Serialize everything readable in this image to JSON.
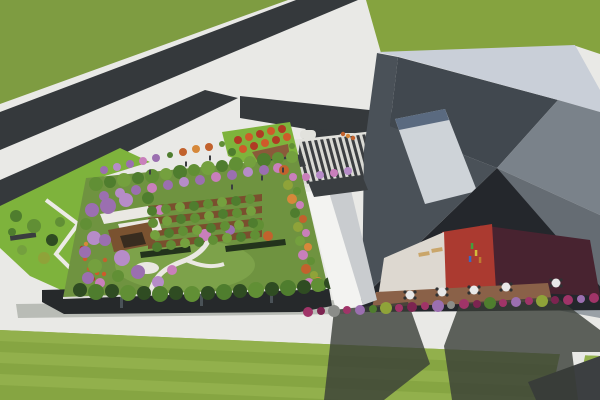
{
  "scene_description": "Aerial 3D architectural rendering: dark diagonal roads through green fields, a rectangular rooftop garden full of trees over a low glass building, a striped entry plaza, a long white canopy building, and a large angular gray building with a sunken courtyard containing red/maroon terraces, deck tables and figures; striped lawn with long building shadows below.",
  "palette": {
    "grassTop": "#7e9c41",
    "grassTop2": "#85a33f",
    "lawn": "#86a542",
    "lawnLight": "#92b04c",
    "sidewalk": "#e9e9e6",
    "road": "#35393c",
    "shade": "#383d37",
    "plazaLight": "#d9d9d4",
    "plazaDark": "#3b3e41",
    "apron": "#e2e2dd",
    "gardenLawn": "#6f9340",
    "gardenLawn2": "#7da24a",
    "soil": "#7a4f2e",
    "hedge": "#23331c",
    "facade": "#26292b",
    "facadeGlint": "#4a5257",
    "parapet": "#dcdcd8",
    "pathWhite": "#eae8e2",
    "deckBrown": "#8a6148",
    "pavilionRoof": "#eae8e3",
    "pavilionDeck": "#7a5230",
    "pavilionDark": "#382c1f",
    "courtWhite": "#ddd8d0",
    "courtRed": "#ab3a30",
    "courtMaroon": "#482330",
    "courtDark": "#24272c",
    "canopyLight": "#f3f3f1",
    "canopyMid": "#c9cccf",
    "bLight": "#c9cfd8",
    "bSunken": "#41484f",
    "bWallLeft": "#4a5158",
    "bPanel": "#ced3d8",
    "bPanelEdge": "#5a6a80",
    "bPlaneA": "#7a828a",
    "bPlaneB": "#656c73",
    "bPlaneC": "#99a0a6",
    "shelterDark": "#3a3e41",
    "benchDark": "#3a3d3f",
    "rampWhite": "#eceae6",
    "parkBright": "#7eb33c",
    "soilTri": "#8a5a3a",
    "darkCorner": "#3c3f41",
    "shadowSoft": "#b9bcb6",
    "tan": "#caa66a",
    "tableWhite": "#e8e8e8",
    "chairDark": "#2f3133",
    "g1": "#4f7d2e",
    "g2": "#618f35",
    "g3": "#74a03e",
    "dg": "#2f4c22",
    "ol": "#8fa339",
    "pu": "#9b6fb0",
    "pl": "#b68cc8",
    "pk": "#c97fbb",
    "or1": "#c2622d",
    "or2": "#d6883a",
    "r1": "#b03a24",
    "r2": "#cf5a2a",
    "mg": "#a03468",
    "mgd": "#7c2450",
    "gr": "#8b8d89"
  },
  "scene": {
    "trees": [
      {
        "x": 96,
        "y": 184,
        "r": 7,
        "c": "g2"
      },
      {
        "x": 110,
        "y": 182,
        "r": 6,
        "c": "g1"
      },
      {
        "x": 124,
        "y": 180,
        "r": 7,
        "c": "g3"
      },
      {
        "x": 138,
        "y": 178,
        "r": 6,
        "c": "g1"
      },
      {
        "x": 152,
        "y": 176,
        "r": 7,
        "c": "g2"
      },
      {
        "x": 166,
        "y": 174,
        "r": 6,
        "c": "g3"
      },
      {
        "x": 180,
        "y": 172,
        "r": 7,
        "c": "g1"
      },
      {
        "x": 194,
        "y": 170,
        "r": 6,
        "c": "g2"
      },
      {
        "x": 208,
        "y": 168,
        "r": 7,
        "c": "g3"
      },
      {
        "x": 222,
        "y": 166,
        "r": 6,
        "c": "g1"
      },
      {
        "x": 236,
        "y": 164,
        "r": 7,
        "c": "g2"
      },
      {
        "x": 250,
        "y": 162,
        "r": 6,
        "c": "g3"
      },
      {
        "x": 264,
        "y": 160,
        "r": 7,
        "c": "g1"
      },
      {
        "x": 278,
        "y": 158,
        "r": 6,
        "c": "g2"
      },
      {
        "x": 292,
        "y": 157,
        "r": 6,
        "c": "g3"
      },
      {
        "x": 104,
        "y": 196,
        "r": 5,
        "c": "pu"
      },
      {
        "x": 120,
        "y": 193,
        "r": 5,
        "c": "pl"
      },
      {
        "x": 136,
        "y": 190,
        "r": 5,
        "c": "pu"
      },
      {
        "x": 152,
        "y": 188,
        "r": 5,
        "c": "pk"
      },
      {
        "x": 168,
        "y": 185,
        "r": 5,
        "c": "pu"
      },
      {
        "x": 184,
        "y": 182,
        "r": 5,
        "c": "pl"
      },
      {
        "x": 200,
        "y": 180,
        "r": 5,
        "c": "pu"
      },
      {
        "x": 216,
        "y": 177,
        "r": 5,
        "c": "pk"
      },
      {
        "x": 232,
        "y": 175,
        "r": 5,
        "c": "pu"
      },
      {
        "x": 248,
        "y": 172,
        "r": 5,
        "c": "pl"
      },
      {
        "x": 264,
        "y": 170,
        "r": 5,
        "c": "pu"
      },
      {
        "x": 278,
        "y": 168,
        "r": 5,
        "c": "pk"
      },
      {
        "x": 92,
        "y": 210,
        "r": 7,
        "c": "pu"
      },
      {
        "x": 86,
        "y": 224,
        "r": 6,
        "c": "g2"
      },
      {
        "x": 94,
        "y": 238,
        "r": 7,
        "c": "pl"
      },
      {
        "x": 85,
        "y": 252,
        "r": 6,
        "c": "pu"
      },
      {
        "x": 95,
        "y": 266,
        "r": 7,
        "c": "g3"
      },
      {
        "x": 88,
        "y": 278,
        "r": 6,
        "c": "pu"
      },
      {
        "x": 100,
        "y": 283,
        "r": 5,
        "c": "pk"
      },
      {
        "x": 108,
        "y": 206,
        "r": 8,
        "c": "pu"
      },
      {
        "x": 126,
        "y": 200,
        "r": 7,
        "c": "pl"
      },
      {
        "x": 148,
        "y": 198,
        "r": 6,
        "c": "g1"
      },
      {
        "x": 160,
        "y": 210,
        "r": 5,
        "c": "pk"
      },
      {
        "x": 105,
        "y": 240,
        "r": 6,
        "c": "pu"
      },
      {
        "x": 122,
        "y": 258,
        "r": 8,
        "c": "pl"
      },
      {
        "x": 138,
        "y": 272,
        "r": 7,
        "c": "pu"
      },
      {
        "x": 158,
        "y": 282,
        "r": 6,
        "c": "pl"
      },
      {
        "x": 172,
        "y": 270,
        "r": 5,
        "c": "pk"
      },
      {
        "x": 118,
        "y": 276,
        "r": 6,
        "c": "g2"
      },
      {
        "x": 205,
        "y": 235,
        "r": 6,
        "c": "pk"
      },
      {
        "x": 230,
        "y": 230,
        "r": 5,
        "c": "pu"
      },
      {
        "x": 258,
        "y": 225,
        "r": 6,
        "c": "g2"
      },
      {
        "x": 268,
        "y": 236,
        "r": 5,
        "c": "or1"
      },
      {
        "x": 152,
        "y": 211,
        "r": 5,
        "c": "g1"
      },
      {
        "x": 166,
        "y": 209,
        "r": 5,
        "c": "g2"
      },
      {
        "x": 180,
        "y": 207,
        "r": 5,
        "c": "g3"
      },
      {
        "x": 194,
        "y": 206,
        "r": 5,
        "c": "g1"
      },
      {
        "x": 208,
        "y": 204,
        "r": 5,
        "c": "g2"
      },
      {
        "x": 222,
        "y": 202,
        "r": 5,
        "c": "g3"
      },
      {
        "x": 236,
        "y": 201,
        "r": 5,
        "c": "g1"
      },
      {
        "x": 250,
        "y": 199,
        "r": 5,
        "c": "g2"
      },
      {
        "x": 153,
        "y": 223,
        "r": 5,
        "c": "g2"
      },
      {
        "x": 167,
        "y": 221,
        "r": 5,
        "c": "g3"
      },
      {
        "x": 181,
        "y": 219,
        "r": 5,
        "c": "g1"
      },
      {
        "x": 195,
        "y": 218,
        "r": 5,
        "c": "g2"
      },
      {
        "x": 209,
        "y": 216,
        "r": 5,
        "c": "g3"
      },
      {
        "x": 223,
        "y": 214,
        "r": 5,
        "c": "g1"
      },
      {
        "x": 237,
        "y": 213,
        "r": 5,
        "c": "g2"
      },
      {
        "x": 251,
        "y": 211,
        "r": 5,
        "c": "g3"
      },
      {
        "x": 155,
        "y": 235,
        "r": 5,
        "c": "g3"
      },
      {
        "x": 169,
        "y": 233,
        "r": 5,
        "c": "g1"
      },
      {
        "x": 183,
        "y": 231,
        "r": 5,
        "c": "g2"
      },
      {
        "x": 197,
        "y": 230,
        "r": 5,
        "c": "g3"
      },
      {
        "x": 211,
        "y": 228,
        "r": 5,
        "c": "g1"
      },
      {
        "x": 225,
        "y": 226,
        "r": 5,
        "c": "g2"
      },
      {
        "x": 239,
        "y": 225,
        "r": 5,
        "c": "g3"
      },
      {
        "x": 253,
        "y": 223,
        "r": 5,
        "c": "g1"
      },
      {
        "x": 157,
        "y": 247,
        "r": 5,
        "c": "g1"
      },
      {
        "x": 171,
        "y": 245,
        "r": 5,
        "c": "g2"
      },
      {
        "x": 185,
        "y": 243,
        "r": 5,
        "c": "g3"
      },
      {
        "x": 199,
        "y": 242,
        "r": 5,
        "c": "g1"
      },
      {
        "x": 213,
        "y": 240,
        "r": 5,
        "c": "g2"
      },
      {
        "x": 227,
        "y": 238,
        "r": 5,
        "c": "g3"
      },
      {
        "x": 241,
        "y": 237,
        "r": 5,
        "c": "g1"
      },
      {
        "x": 255,
        "y": 235,
        "r": 5,
        "c": "g2"
      },
      {
        "x": 284,
        "y": 170,
        "r": 5,
        "c": "or1"
      },
      {
        "x": 293,
        "y": 177,
        "r": 4,
        "c": "pk"
      },
      {
        "x": 288,
        "y": 185,
        "r": 5,
        "c": "ol"
      },
      {
        "x": 297,
        "y": 191,
        "r": 4,
        "c": "g2"
      },
      {
        "x": 292,
        "y": 199,
        "r": 5,
        "c": "or2"
      },
      {
        "x": 300,
        "y": 205,
        "r": 4,
        "c": "pk"
      },
      {
        "x": 295,
        "y": 213,
        "r": 5,
        "c": "g1"
      },
      {
        "x": 303,
        "y": 219,
        "r": 4,
        "c": "or1"
      },
      {
        "x": 298,
        "y": 227,
        "r": 5,
        "c": "ol"
      },
      {
        "x": 306,
        "y": 233,
        "r": 4,
        "c": "pk"
      },
      {
        "x": 300,
        "y": 241,
        "r": 5,
        "c": "g3"
      },
      {
        "x": 308,
        "y": 247,
        "r": 4,
        "c": "or2"
      },
      {
        "x": 303,
        "y": 255,
        "r": 5,
        "c": "pk"
      },
      {
        "x": 311,
        "y": 261,
        "r": 4,
        "c": "g2"
      },
      {
        "x": 306,
        "y": 269,
        "r": 5,
        "c": "or1"
      },
      {
        "x": 314,
        "y": 275,
        "r": 4,
        "c": "ol"
      },
      {
        "x": 309,
        "y": 283,
        "r": 5,
        "c": "pk"
      },
      {
        "x": 318,
        "y": 281,
        "r": 4,
        "c": "or2"
      },
      {
        "x": 322,
        "y": 287,
        "r": 4,
        "c": "g1"
      },
      {
        "x": 80,
        "y": 290,
        "r": 7,
        "c": "dg"
      },
      {
        "x": 96,
        "y": 292,
        "r": 8,
        "c": "g1"
      },
      {
        "x": 112,
        "y": 291,
        "r": 7,
        "c": "dg"
      },
      {
        "x": 128,
        "y": 293,
        "r": 8,
        "c": "g2"
      },
      {
        "x": 144,
        "y": 293,
        "r": 7,
        "c": "dg"
      },
      {
        "x": 160,
        "y": 294,
        "r": 8,
        "c": "g1"
      },
      {
        "x": 176,
        "y": 293,
        "r": 7,
        "c": "dg"
      },
      {
        "x": 192,
        "y": 294,
        "r": 8,
        "c": "g2"
      },
      {
        "x": 208,
        "y": 293,
        "r": 7,
        "c": "dg"
      },
      {
        "x": 224,
        "y": 292,
        "r": 8,
        "c": "g1"
      },
      {
        "x": 240,
        "y": 291,
        "r": 7,
        "c": "dg"
      },
      {
        "x": 256,
        "y": 290,
        "r": 8,
        "c": "g2"
      },
      {
        "x": 272,
        "y": 289,
        "r": 7,
        "c": "dg"
      },
      {
        "x": 288,
        "y": 288,
        "r": 8,
        "c": "g1"
      },
      {
        "x": 304,
        "y": 287,
        "r": 7,
        "c": "dg"
      },
      {
        "x": 318,
        "y": 285,
        "r": 7,
        "c": "g2"
      },
      {
        "x": 330,
        "y": 283,
        "r": 6,
        "c": "dg"
      },
      {
        "x": 104,
        "y": 170,
        "r": 4,
        "c": "pu"
      },
      {
        "x": 117,
        "y": 167,
        "r": 4,
        "c": "pl"
      },
      {
        "x": 130,
        "y": 164,
        "r": 4,
        "c": "pu"
      },
      {
        "x": 143,
        "y": 161,
        "r": 4,
        "c": "pk"
      },
      {
        "x": 156,
        "y": 158,
        "r": 4,
        "c": "pu"
      },
      {
        "x": 170,
        "y": 155,
        "r": 3,
        "c": "g1"
      },
      {
        "x": 183,
        "y": 152,
        "r": 4,
        "c": "or1"
      },
      {
        "x": 196,
        "y": 149,
        "r": 4,
        "c": "or2"
      },
      {
        "x": 209,
        "y": 147,
        "r": 4,
        "c": "or1"
      },
      {
        "x": 222,
        "y": 144,
        "r": 3,
        "c": "g2"
      },
      {
        "x": 16,
        "y": 216,
        "r": 6,
        "c": "g1"
      },
      {
        "x": 34,
        "y": 226,
        "r": 7,
        "c": "g2"
      },
      {
        "x": 52,
        "y": 240,
        "r": 6,
        "c": "dg"
      },
      {
        "x": 22,
        "y": 250,
        "r": 5,
        "c": "g3"
      },
      {
        "x": 44,
        "y": 258,
        "r": 6,
        "c": "ol"
      },
      {
        "x": 60,
        "y": 222,
        "r": 5,
        "c": "g2"
      },
      {
        "x": 12,
        "y": 232,
        "r": 4,
        "c": "g1"
      },
      {
        "x": 238,
        "y": 140,
        "r": 4,
        "c": "r1"
      },
      {
        "x": 249,
        "y": 137,
        "r": 4,
        "c": "r2"
      },
      {
        "x": 260,
        "y": 134,
        "r": 4,
        "c": "r1"
      },
      {
        "x": 271,
        "y": 131,
        "r": 4,
        "c": "r2"
      },
      {
        "x": 282,
        "y": 129,
        "r": 4,
        "c": "r1"
      },
      {
        "x": 243,
        "y": 149,
        "r": 4,
        "c": "r2"
      },
      {
        "x": 254,
        "y": 146,
        "r": 4,
        "c": "r1"
      },
      {
        "x": 265,
        "y": 143,
        "r": 4,
        "c": "r2"
      },
      {
        "x": 276,
        "y": 140,
        "r": 4,
        "c": "r1"
      },
      {
        "x": 287,
        "y": 137,
        "r": 4,
        "c": "r2"
      },
      {
        "x": 232,
        "y": 152,
        "r": 4,
        "c": "g1"
      },
      {
        "x": 292,
        "y": 146,
        "r": 3,
        "c": "g2"
      },
      {
        "x": 306,
        "y": 177,
        "r": 4,
        "c": "pk"
      },
      {
        "x": 320,
        "y": 175,
        "r": 4,
        "c": "pl"
      },
      {
        "x": 334,
        "y": 173,
        "r": 4,
        "c": "pk"
      },
      {
        "x": 348,
        "y": 171,
        "r": 4,
        "c": "pl"
      }
    ],
    "base_shrubs": [
      {
        "x": 308,
        "y": 312,
        "r": 5,
        "c": "mg"
      },
      {
        "x": 321,
        "y": 311,
        "r": 4,
        "c": "mgd"
      },
      {
        "x": 334,
        "y": 311,
        "r": 6,
        "c": "gr"
      },
      {
        "x": 347,
        "y": 310,
        "r": 4,
        "c": "mg"
      },
      {
        "x": 360,
        "y": 310,
        "r": 5,
        "c": "pu"
      },
      {
        "x": 373,
        "y": 309,
        "r": 4,
        "c": "g1"
      },
      {
        "x": 386,
        "y": 308,
        "r": 6,
        "c": "ol"
      },
      {
        "x": 399,
        "y": 308,
        "r": 4,
        "c": "mg"
      },
      {
        "x": 412,
        "y": 307,
        "r": 5,
        "c": "mgd"
      },
      {
        "x": 425,
        "y": 306,
        "r": 4,
        "c": "mg"
      },
      {
        "x": 438,
        "y": 306,
        "r": 6,
        "c": "pu"
      },
      {
        "x": 451,
        "y": 305,
        "r": 4,
        "c": "gr"
      },
      {
        "x": 464,
        "y": 304,
        "r": 5,
        "c": "mg"
      },
      {
        "x": 477,
        "y": 304,
        "r": 4,
        "c": "mgd"
      },
      {
        "x": 490,
        "y": 303,
        "r": 6,
        "c": "g1"
      },
      {
        "x": 503,
        "y": 303,
        "r": 4,
        "c": "mg"
      },
      {
        "x": 516,
        "y": 302,
        "r": 5,
        "c": "pu"
      },
      {
        "x": 529,
        "y": 301,
        "r": 4,
        "c": "mg"
      },
      {
        "x": 542,
        "y": 301,
        "r": 6,
        "c": "ol"
      },
      {
        "x": 555,
        "y": 300,
        "r": 4,
        "c": "mgd"
      },
      {
        "x": 568,
        "y": 300,
        "r": 5,
        "c": "mg"
      },
      {
        "x": 581,
        "y": 299,
        "r": 4,
        "c": "pu"
      },
      {
        "x": 594,
        "y": 298,
        "r": 5,
        "c": "mg"
      }
    ],
    "flower_dots": [
      {
        "x": 82,
        "y": 248,
        "c": "r1"
      },
      {
        "x": 89,
        "y": 253,
        "c": "or1"
      },
      {
        "x": 85,
        "y": 259,
        "c": "r2"
      },
      {
        "x": 93,
        "y": 263,
        "c": "r1"
      },
      {
        "x": 89,
        "y": 269,
        "c": "or1"
      },
      {
        "x": 97,
        "y": 273,
        "c": "r2"
      },
      {
        "x": 93,
        "y": 279,
        "c": "r1"
      },
      {
        "x": 101,
        "y": 281,
        "c": "or1"
      },
      {
        "x": 104,
        "y": 274,
        "c": "r2"
      },
      {
        "x": 86,
        "y": 244,
        "c": "or2"
      },
      {
        "x": 99,
        "y": 266,
        "c": "r1"
      },
      {
        "x": 105,
        "y": 260,
        "c": "or1"
      },
      {
        "x": 343,
        "y": 134,
        "c": "or1"
      },
      {
        "x": 348,
        "y": 136,
        "c": "or2"
      },
      {
        "x": 353,
        "y": 138,
        "c": "or1"
      }
    ],
    "tables": [
      {
        "x": 410,
        "y": 295
      },
      {
        "x": 442,
        "y": 292
      },
      {
        "x": 474,
        "y": 290
      },
      {
        "x": 506,
        "y": 287
      },
      {
        "x": 556,
        "y": 283
      }
    ],
    "lounges": [
      {
        "x": 424,
        "y": 254,
        "rot": -10
      },
      {
        "x": 437,
        "y": 250,
        "rot": -10
      }
    ],
    "people": [
      {
        "x": 472,
        "y": 246,
        "c": "#44a03c"
      },
      {
        "x": 476,
        "y": 253,
        "c": "#d2bc3c"
      },
      {
        "x": 470,
        "y": 259,
        "c": "#3f67c0"
      },
      {
        "x": 480,
        "y": 260,
        "c": "#bd7c30"
      }
    ],
    "walkers": [
      {
        "x": 150,
        "y": 172
      },
      {
        "x": 186,
        "y": 164
      },
      {
        "x": 262,
        "y": 178
      },
      {
        "x": 283,
        "y": 170
      },
      {
        "x": 232,
        "y": 187
      },
      {
        "x": 210,
        "y": 158
      }
    ]
  }
}
